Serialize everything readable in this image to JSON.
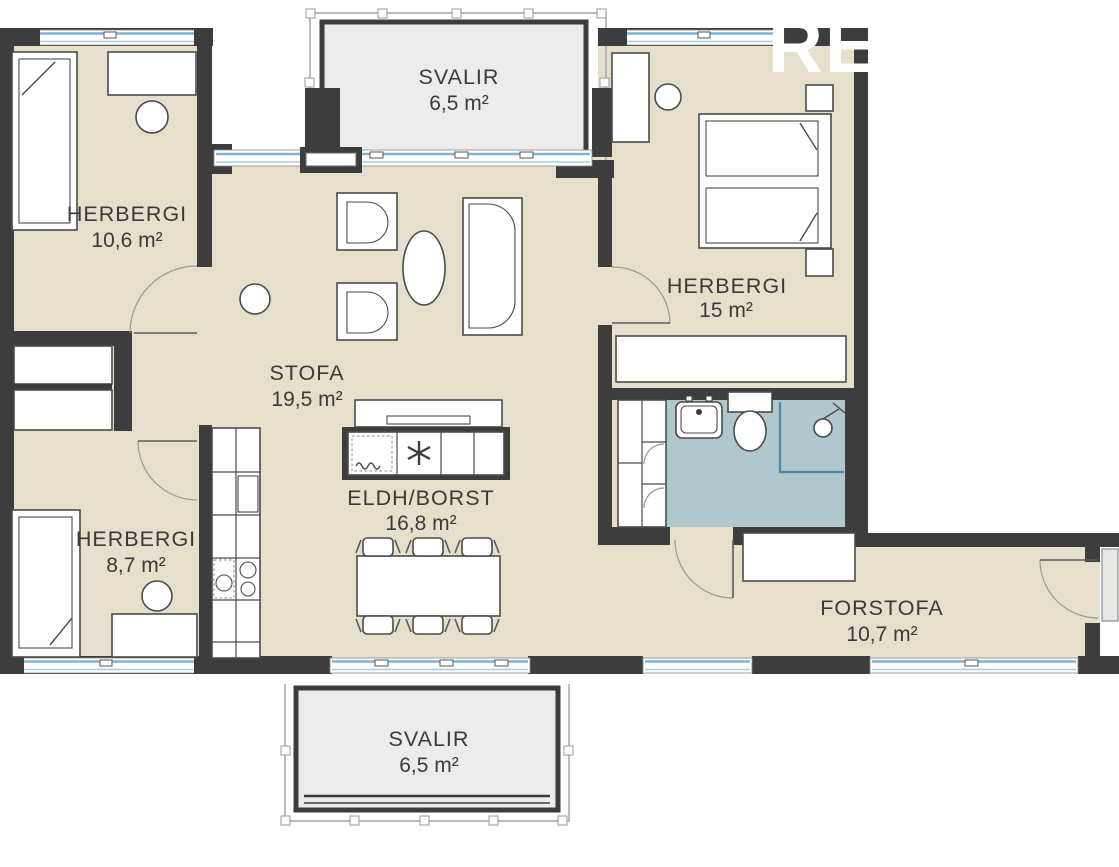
{
  "plan": {
    "title": "apartment-floor-plan",
    "rooms": [
      {
        "key": "svalir-top",
        "name": "SVALIR",
        "area": "6,5 m²"
      },
      {
        "key": "herbergi-nw",
        "name": "HERBERGI",
        "area": "10,6 m²"
      },
      {
        "key": "herbergi-e",
        "name": "HERBERGI",
        "area": "15 m²"
      },
      {
        "key": "stofa",
        "name": "STOFA",
        "area": "19,5 m²"
      },
      {
        "key": "eldhus-borst",
        "name": "ELDH/BORST",
        "area": "16,8 m²"
      },
      {
        "key": "herbergi-sw",
        "name": "HERBERGI",
        "area": "8,7 m²"
      },
      {
        "key": "forstofa",
        "name": "FORSTOFA",
        "area": "10,7 m²"
      },
      {
        "key": "svalir-bottom",
        "name": "SVALIR",
        "area": "6,5 m²"
      }
    ],
    "watermark": "RE",
    "colors": {
      "floor": "#e5dfcc",
      "wall": "#3d3d3d",
      "bathroom_floor": "#afc7cd",
      "balcony_floor": "#ececec",
      "glazing": "#7fb3d3"
    }
  }
}
